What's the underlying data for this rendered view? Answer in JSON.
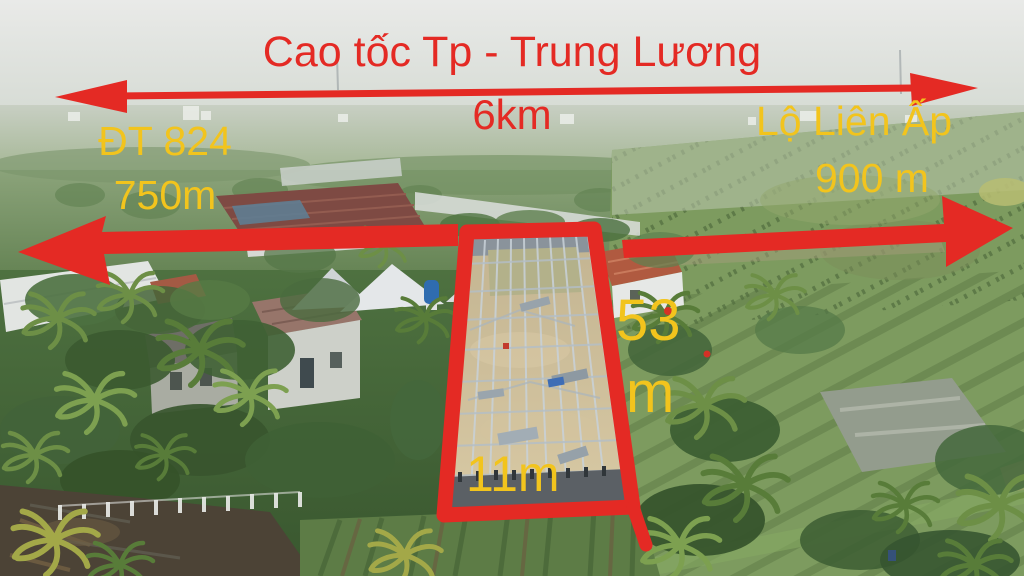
{
  "colors": {
    "annotation_red": "#e42a24",
    "label_yellow": "#f2c41d"
  },
  "annotations": {
    "highway": {
      "name": "Cao tốc Tp - Trung Lương",
      "distance": "6km"
    },
    "left_road": {
      "name": "ĐT 824",
      "distance": "750m"
    },
    "right_road": {
      "name": "Lộ Liên Ấp",
      "distance": "900 m"
    },
    "plot": {
      "side_length": "53",
      "side_unit": "m",
      "front_width": "11m"
    }
  }
}
